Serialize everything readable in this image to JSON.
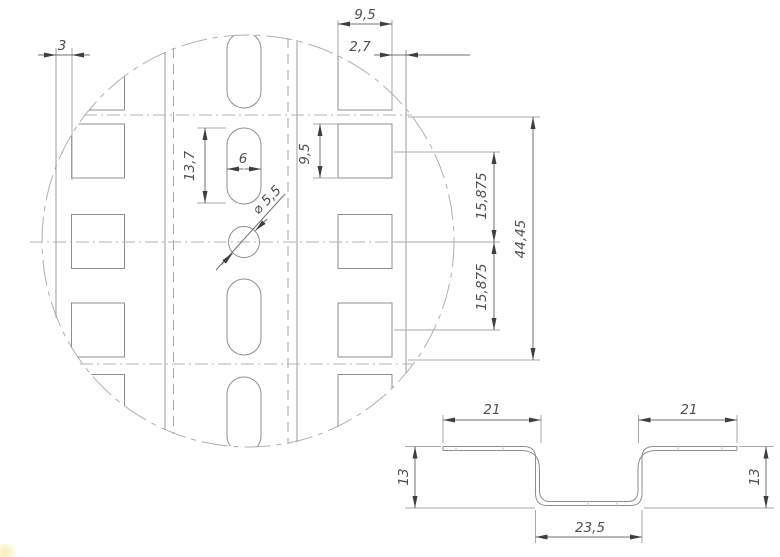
{
  "drawing": {
    "type": "engineering-drawing",
    "views": {
      "detail_view": "perforated-din-rail-top-view-detail-circle",
      "section_view": "hat-profile-cross-section"
    },
    "colors": {
      "background": "#ffffff",
      "geometry_line": "#8f8f8f",
      "hidden_line": "#a5a5a5",
      "centerline": "#b3b3b3",
      "dimension_line": "#6f6f6f",
      "arrow": "#3f3f3f",
      "text": "#4f4f4f"
    },
    "dims": {
      "left_offset": "3",
      "square_w": "9,5",
      "right_offset": "2,7",
      "slot_len": "13,7",
      "slot_w": "6",
      "hole_dia": "⌀ 5,5",
      "square_h": "9,5",
      "pitch_a": "15,875",
      "pitch_b": "15,875",
      "group_len": "44,45",
      "flange_l": "21",
      "flange_r": "21",
      "height_l": "13",
      "height_r": "13",
      "channel_w": "23,5"
    }
  }
}
